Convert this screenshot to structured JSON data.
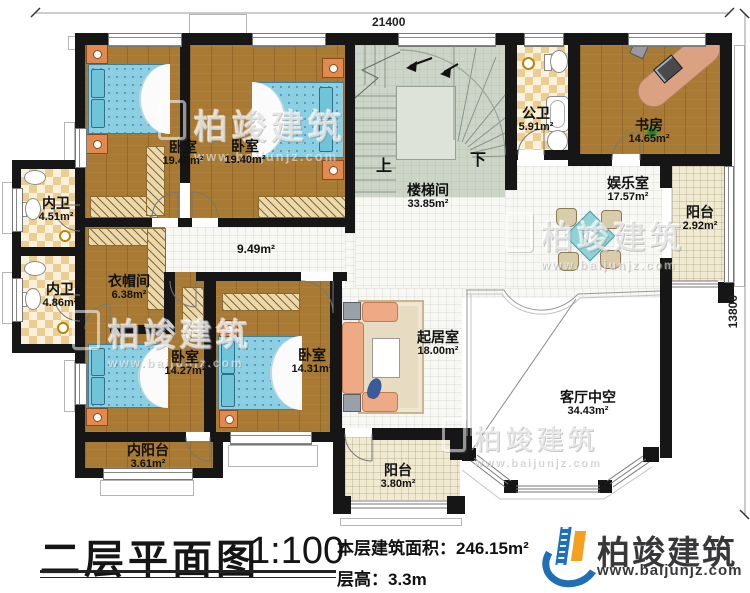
{
  "dimensions": {
    "width_mm": "21400",
    "height_mm": "13800"
  },
  "rooms": [
    {
      "name": "卧室",
      "area": "19.40m²"
    },
    {
      "name": "卧室",
      "area": "19.40m²"
    },
    {
      "name": "楼梯间",
      "area": "33.85m²"
    },
    {
      "name": "公卫",
      "area": "5.91m²"
    },
    {
      "name": "书房",
      "area": "14.65m²"
    },
    {
      "name": "娱乐室",
      "area": "17.57m²"
    },
    {
      "name": "阳台",
      "area": "2.92m²"
    },
    {
      "name": "内卫",
      "area": "4.51m²"
    },
    {
      "name": "内卫",
      "area": "4.86m²"
    },
    {
      "name": "衣帽间",
      "area": "6.38m²"
    },
    {
      "name": "卧室",
      "area": "14.27m²"
    },
    {
      "name": "卧室",
      "area": "14.31m²"
    },
    {
      "name": "内阳台",
      "area": "3.61m²"
    },
    {
      "name": "起居室",
      "area": "18.00m²"
    },
    {
      "name": "客厅中空",
      "area": "34.43m²"
    },
    {
      "name": "阳台",
      "area": "3.80m²"
    }
  ],
  "corridor_area": "9.49m²",
  "stairs": {
    "up": "上",
    "down": "下"
  },
  "title_block": {
    "title": "二层平面图",
    "scale": "1:100",
    "area_label": "本层建筑面积：",
    "area_value": "246.15m²",
    "floor_height_label": "层高：",
    "floor_height_value": "3.3m"
  },
  "brand": {
    "name": "柏竣建筑",
    "website": "www.baijunjz.com"
  },
  "watermark": {
    "name": "柏竣建筑",
    "website": "www.baijunjz.com"
  }
}
